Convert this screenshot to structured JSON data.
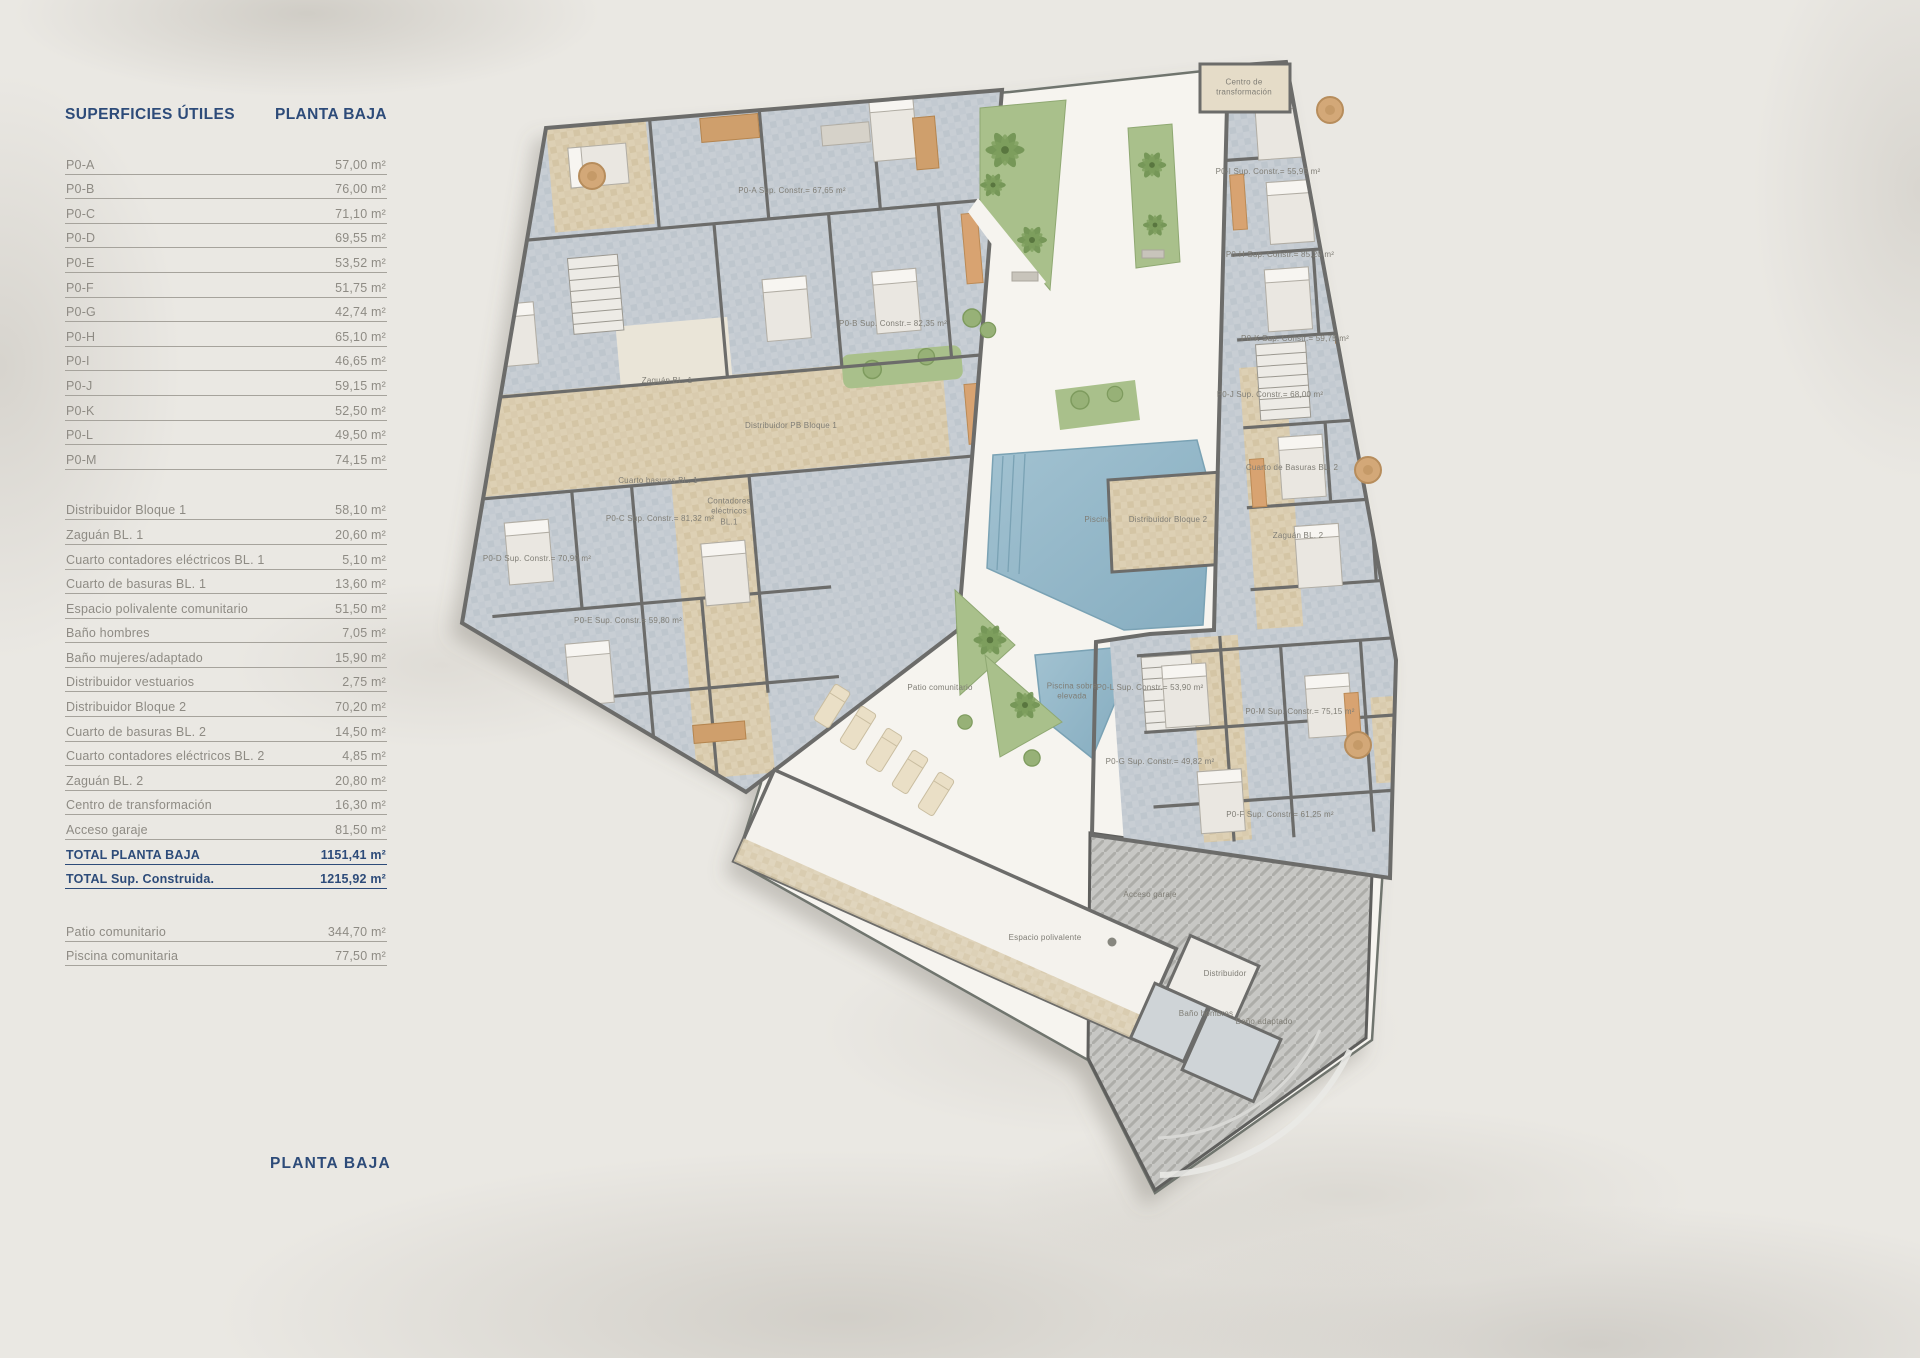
{
  "header": {
    "title_left": "SUPERFICIES ÚTILES",
    "title_right": "PLANTA BAJA"
  },
  "table": {
    "sections": [
      {
        "id": "apartments",
        "style": "normal",
        "rows": [
          {
            "label": "P0-A",
            "value": "57,00 m²"
          },
          {
            "label": "P0-B",
            "value": "76,00 m²"
          },
          {
            "label": "P0-C",
            "value": "71,10 m²"
          },
          {
            "label": "P0-D",
            "value": "69,55 m²"
          },
          {
            "label": "P0-E",
            "value": "53,52 m²"
          },
          {
            "label": "P0-F",
            "value": "51,75 m²"
          },
          {
            "label": "P0-G",
            "value": "42,74 m²"
          },
          {
            "label": "P0-H",
            "value": "65,10 m²"
          },
          {
            "label": "P0-I",
            "value": "46,65 m²"
          },
          {
            "label": "P0-J",
            "value": "59,15 m²"
          },
          {
            "label": "P0-K",
            "value": "52,50 m²"
          },
          {
            "label": "P0-L",
            "value": "49,50 m²"
          },
          {
            "label": "P0-M",
            "value": "74,15 m²"
          }
        ]
      },
      {
        "id": "common",
        "style": "normal",
        "gap_before": "lg",
        "rows": [
          {
            "label": "Distribuidor Bloque 1",
            "value": "58,10 m²"
          },
          {
            "label": "Zaguán BL. 1",
            "value": "20,60 m²"
          },
          {
            "label": "Cuarto contadores eléctricos BL. 1",
            "value": "5,10 m²"
          },
          {
            "label": "Cuarto de basuras BL. 1",
            "value": "13,60 m²"
          },
          {
            "label": "Espacio polivalente comunitario",
            "value": "51,50 m²"
          },
          {
            "label": "Baño hombres",
            "value": "7,05 m²"
          },
          {
            "label": "Baño mujeres/adaptado",
            "value": "15,90 m²"
          },
          {
            "label": "Distribuidor vestuarios",
            "value": "2,75 m²"
          },
          {
            "label": "Distribuidor Bloque 2",
            "value": "70,20 m²"
          },
          {
            "label": "Cuarto de basuras BL. 2",
            "value": "14,50 m²"
          },
          {
            "label": "Cuarto contadores eléctricos BL. 2",
            "value": "4,85 m²"
          },
          {
            "label": "Zaguán BL. 2",
            "value": "20,80 m²"
          },
          {
            "label": "Centro de transformación",
            "value": "16,30 m²"
          },
          {
            "label": "Acceso garaje",
            "value": "81,50 m²"
          }
        ]
      },
      {
        "id": "totals",
        "style": "total",
        "rows": [
          {
            "label": "TOTAL PLANTA BAJA",
            "value": "1151,41 m²"
          },
          {
            "label": "TOTAL Sup. Construida.",
            "value": "1215,92 m²"
          }
        ]
      },
      {
        "id": "outdoor",
        "style": "normal",
        "gap_before": "xl",
        "rows": [
          {
            "label": "Patio comunitario",
            "value": "344,70 m²"
          },
          {
            "label": "Piscina comunitaria",
            "value": "77,50 m²"
          }
        ]
      }
    ]
  },
  "footer": {
    "title": "PLANTA BAJA"
  },
  "colors": {
    "accent_navy": "#2d4b79",
    "paper": "#eae8e3",
    "pool_blue": "#93b8ca",
    "garden_green": "#a9c08b",
    "corridor_beige": "#ddd0b4",
    "room_tile": "#c8ced4",
    "wall_gray": "#6c6c6a"
  },
  "plan": {
    "labels": [
      {
        "text": "P0-A Sup. Constr.= 67,65 m²",
        "x": 792,
        "y": 191
      },
      {
        "text": "P0-B Sup. Constr.= 82,35 m²",
        "x": 893,
        "y": 324
      },
      {
        "text": "Zaguán BL. 1",
        "x": 667,
        "y": 381
      },
      {
        "text": "Distribuidor PB Bloque 1",
        "x": 791,
        "y": 426
      },
      {
        "text": "Cuarto basuras BL. 1",
        "x": 658,
        "y": 481
      },
      {
        "text": "Contadores\neléctricos\nBL.1",
        "x": 729,
        "y": 512
      },
      {
        "text": "P0-C Sup. Constr.= 81,32 m²",
        "x": 660,
        "y": 519
      },
      {
        "text": "P0-D Sup. Constr.= 70,90 m²",
        "x": 537,
        "y": 559
      },
      {
        "text": "P0-E Sup. Constr.= 59,80 m²",
        "x": 628,
        "y": 621
      },
      {
        "text": "Piscina",
        "x": 1098,
        "y": 520
      },
      {
        "text": "Piscina sobre\nelevada",
        "x": 1072,
        "y": 692
      },
      {
        "text": "Patio comunitario",
        "x": 940,
        "y": 688
      },
      {
        "text": "Espacio polivalente",
        "x": 1045,
        "y": 938
      },
      {
        "text": "Distribuidor",
        "x": 1225,
        "y": 974
      },
      {
        "text": "Baño hombres",
        "x": 1206,
        "y": 1014
      },
      {
        "text": "Baño adaptado",
        "x": 1264,
        "y": 1022
      },
      {
        "text": "Acceso garaje",
        "x": 1150,
        "y": 895
      },
      {
        "text": "Centro de\ntransformación",
        "x": 1244,
        "y": 88
      },
      {
        "text": "P0-I Sup. Constr.= 55,95 m²",
        "x": 1268,
        "y": 172
      },
      {
        "text": "P0-H Sup. Constr.= 85,20 m²",
        "x": 1280,
        "y": 255
      },
      {
        "text": "P0-K Sup. Constr.= 59,75 m²",
        "x": 1295,
        "y": 339
      },
      {
        "text": "P0-J Sup. Constr.= 68,00 m²",
        "x": 1270,
        "y": 395
      },
      {
        "text": "Cuarto de Basuras BL. 2",
        "x": 1292,
        "y": 468
      },
      {
        "text": "Distribuidor Bloque 2",
        "x": 1168,
        "y": 520
      },
      {
        "text": "Zaguán BL. 2",
        "x": 1298,
        "y": 536
      },
      {
        "text": "P0-L Sup. Constr.= 53,90 m²",
        "x": 1150,
        "y": 688
      },
      {
        "text": "P0-M Sup. Constr.= 75,15 m²",
        "x": 1300,
        "y": 712
      },
      {
        "text": "P0-G Sup. Constr.= 49,82 m²",
        "x": 1160,
        "y": 762
      },
      {
        "text": "P0-F Sup. Constr.= 61,25 m²",
        "x": 1280,
        "y": 815
      }
    ]
  }
}
